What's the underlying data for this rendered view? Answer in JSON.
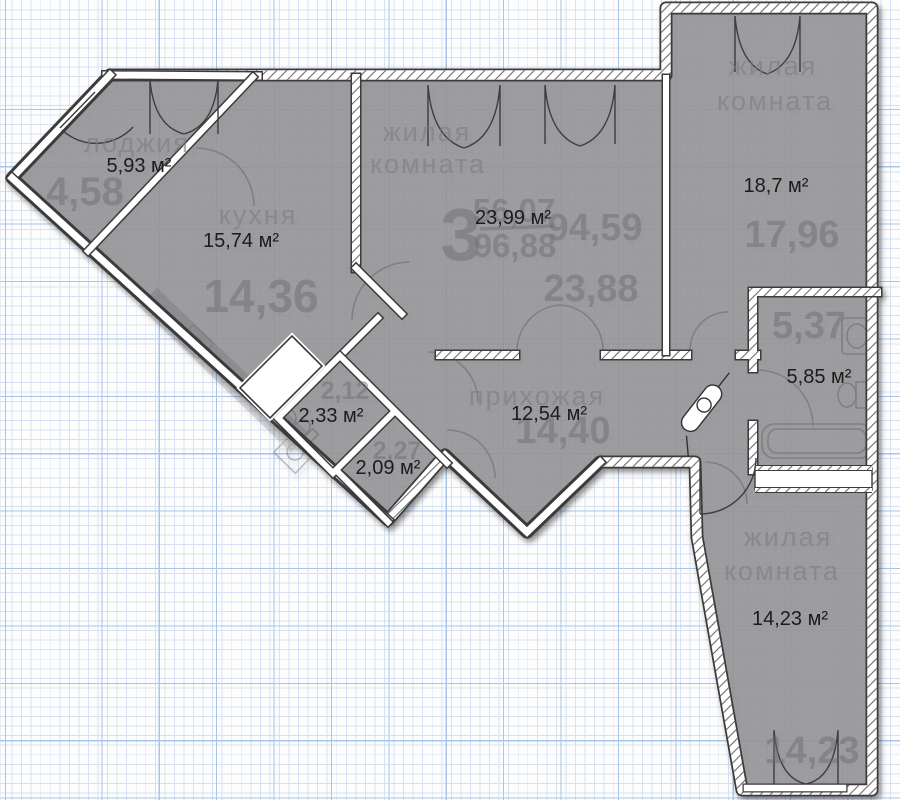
{
  "plan": {
    "summary": {
      "rooms_count": "3",
      "area_numerator": "56,07",
      "area_denominator": "96,88",
      "area_side": "94,59"
    },
    "rooms": [
      {
        "name": "лоджия",
        "area": "5,93 м²",
        "area_old": "4,58"
      },
      {
        "name": "кухня",
        "area": "15,74 м²",
        "area_old": "14,36"
      },
      {
        "name_line1": "жилая",
        "name_line2": "комната",
        "area": "23,99 м²",
        "area_old": "23,88"
      },
      {
        "name_line1": "жилая",
        "name_line2": "комната",
        "area": "18,7 м²",
        "area_old": "17,96"
      },
      {
        "area": "5,85 м²",
        "area_old": "5,37"
      },
      {
        "name": "прихожая",
        "area": "12,54 м²",
        "area_old": "14,40"
      },
      {
        "area": "2,33 м²",
        "area_old": "2,12"
      },
      {
        "area": "2,09 м²",
        "area_old": "2,27"
      },
      {
        "name_line1": "жилая",
        "name_line2": "комната",
        "area": "14,23 м²",
        "area_old": "14,23"
      }
    ],
    "colors": {
      "floor_fill": "#98979b",
      "wall_casing": "#3a3a3a",
      "wall_fill": "#ffffff",
      "grid_minor": "#d6e2f3",
      "grid_major": "#a9c5e7",
      "label_crisp": "#1c1c1c",
      "label_faded": "#6f6e75"
    }
  }
}
